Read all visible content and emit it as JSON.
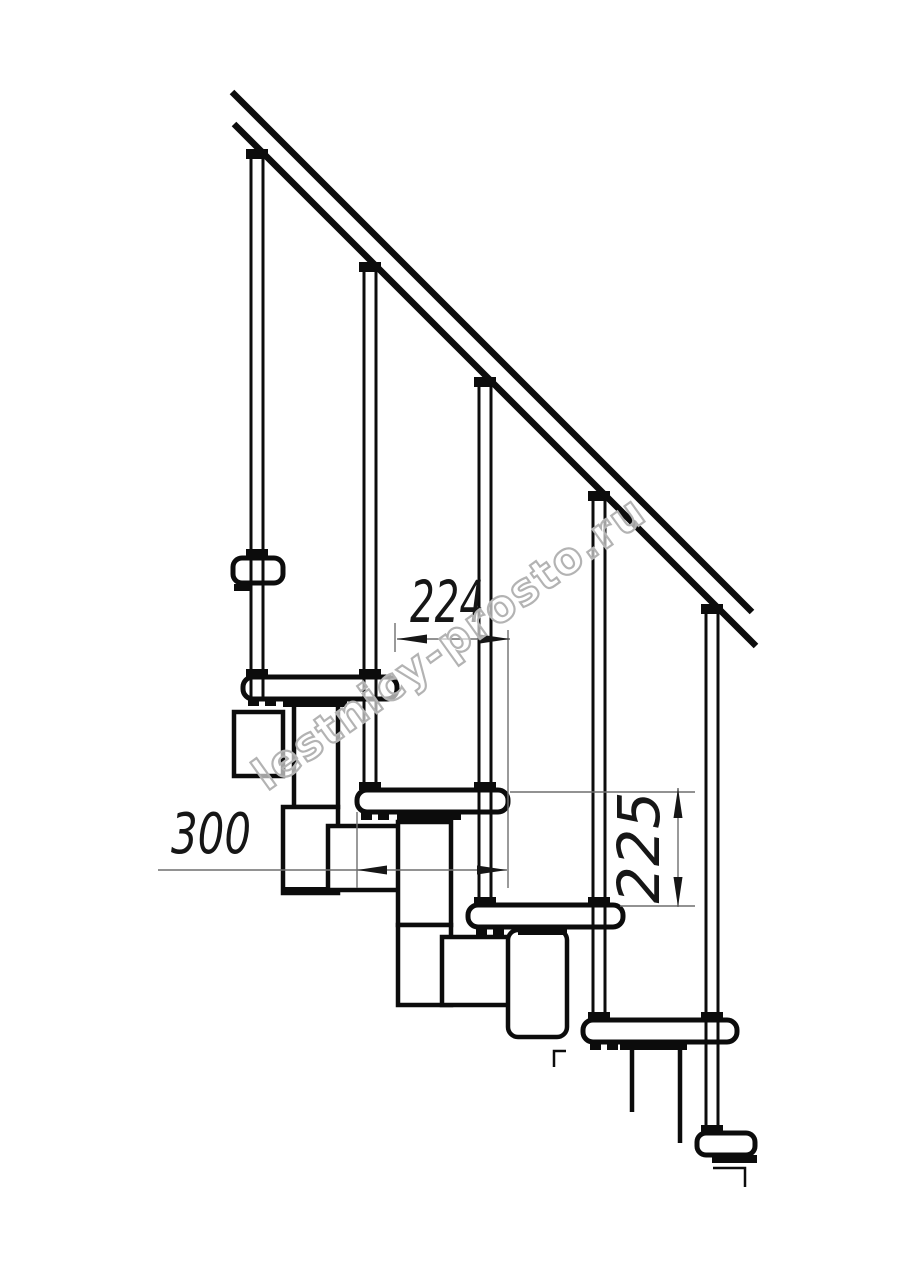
{
  "watermark": {
    "text": "lestnicy-prosto.ru",
    "outline_color": "#b3b3b3"
  },
  "dimensions": {
    "step_run": "224",
    "tread_depth": "300",
    "riser_height": "225"
  },
  "colors": {
    "ink": "#0c0c0c",
    "thin_line": "#6f6f6f",
    "dim_text": "#161616",
    "paper": "#ffffff"
  }
}
